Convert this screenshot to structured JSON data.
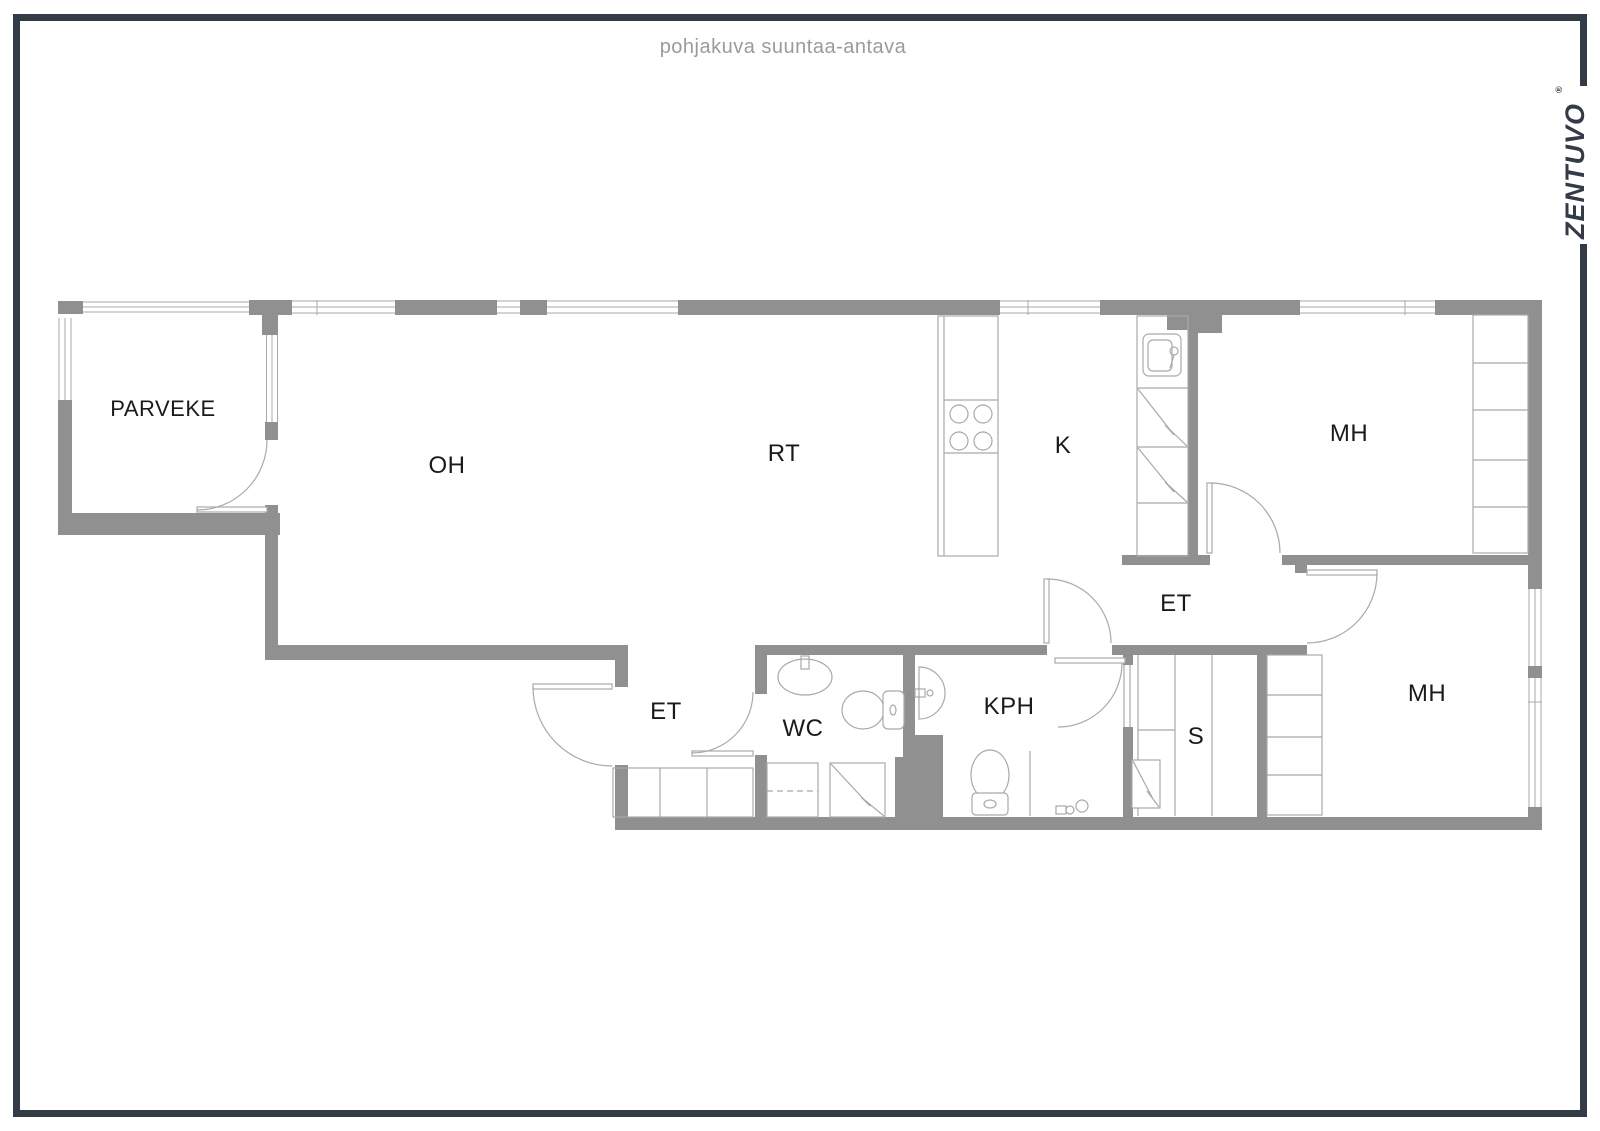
{
  "title": "pohjakuva suuntaa-antava",
  "brand": {
    "logo": "ZENTUVO",
    "registered_mark": "®"
  },
  "floorplan": {
    "rooms": [
      {
        "id": "parveke",
        "label": "PARVEKE",
        "meaning": "balcony"
      },
      {
        "id": "oh",
        "label": "OH",
        "meaning": "living room"
      },
      {
        "id": "rt",
        "label": "RT",
        "meaning": "dining space"
      },
      {
        "id": "k",
        "label": "K",
        "meaning": "kitchen"
      },
      {
        "id": "mh1",
        "label": "MH",
        "meaning": "bedroom 1"
      },
      {
        "id": "et1",
        "label": "ET",
        "meaning": "entrance hall upper"
      },
      {
        "id": "et2",
        "label": "ET",
        "meaning": "entrance hall lower"
      },
      {
        "id": "wc",
        "label": "WC",
        "meaning": "toilet"
      },
      {
        "id": "kph",
        "label": "KPH",
        "meaning": "bathroom"
      },
      {
        "id": "s",
        "label": "S",
        "meaning": "sauna"
      },
      {
        "id": "mh2",
        "label": "MH",
        "meaning": "bedroom 2"
      }
    ],
    "colors": {
      "wall": "#909090",
      "fixture_line": "#a9a9a9",
      "frame": "#333b47",
      "label_text": "#1a1a1a",
      "title_text": "#9b9b9b",
      "background": "#ffffff"
    }
  }
}
